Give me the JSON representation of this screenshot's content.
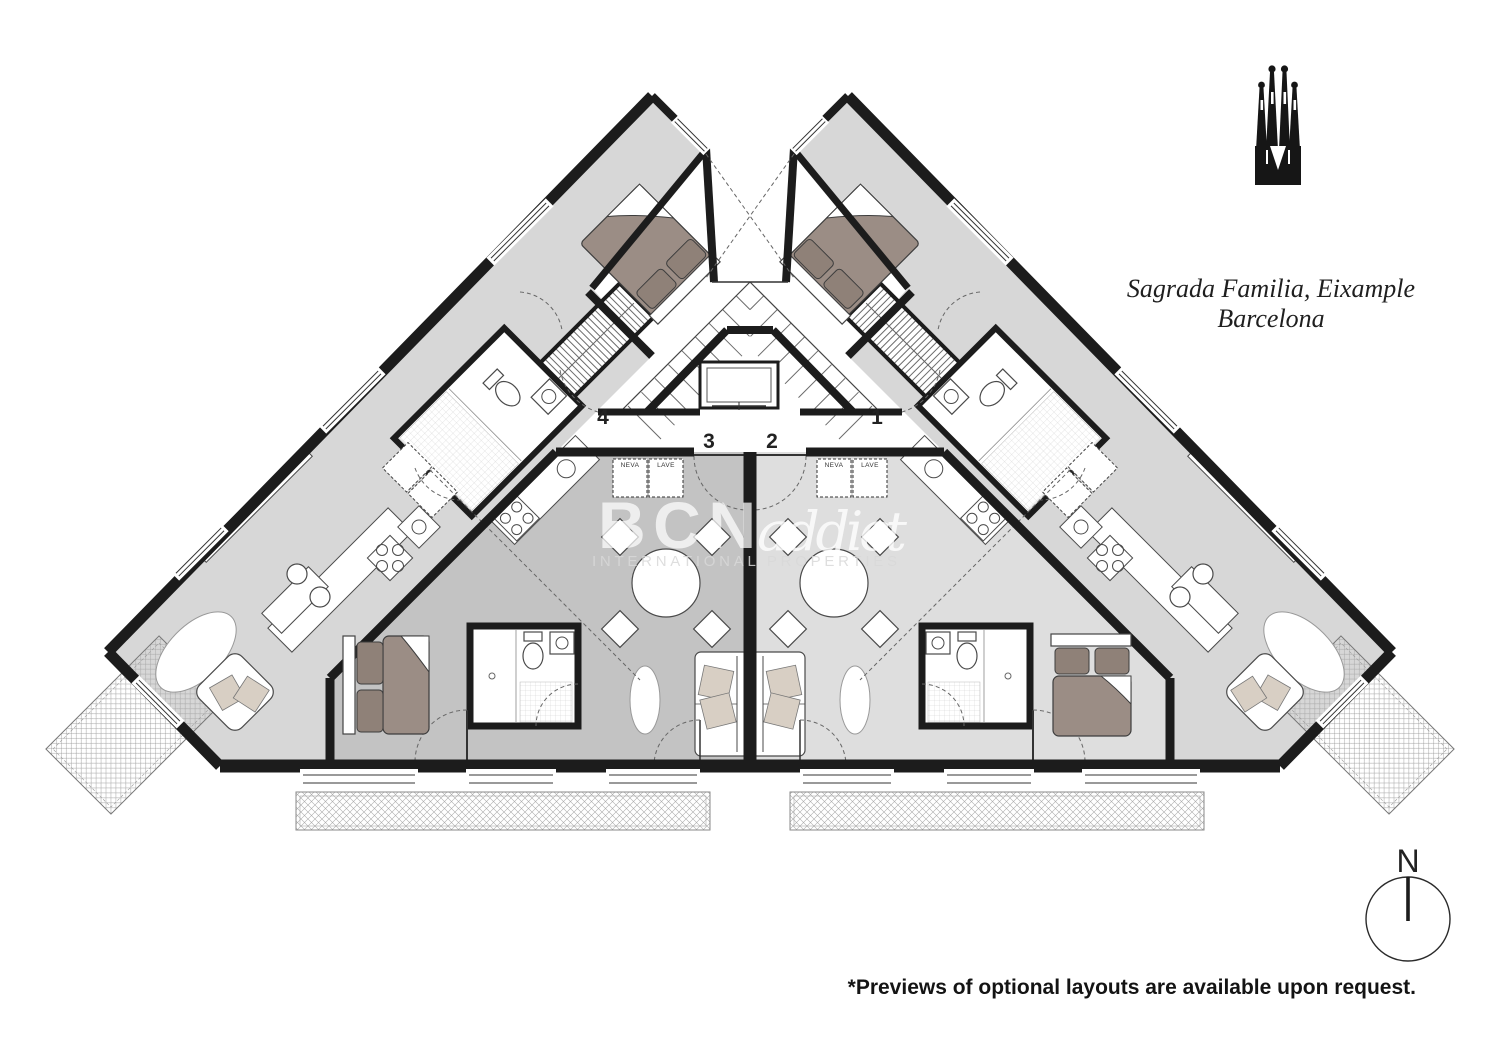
{
  "header": {
    "title_line1": "Sagrada Familia, Eixample",
    "title_line2": "Barcelona"
  },
  "watermark": {
    "brand_bold": "BCN",
    "brand_script": "addict",
    "tagline": "INTERNATIONAL PROPERTIES"
  },
  "compass": {
    "north_label": "N"
  },
  "footnote": "*Previews of optional layouts are available upon request.",
  "plan": {
    "unit_labels": {
      "unit1": "1",
      "unit2": "2",
      "unit3": "3",
      "unit4": "4"
    },
    "appliance_labels": {
      "fridge": "NEVA",
      "washer": "LAVE"
    },
    "colors": {
      "wall": "#1c1c1c",
      "wing_floor": "#d7d7d7",
      "unit3_floor": "#c3c3c3",
      "unit2_floor": "#dedede",
      "bed_blanket": "#9b8d85",
      "bed_pillow": "#8f8178",
      "sofa_cushion": "#d8cfc4"
    }
  }
}
